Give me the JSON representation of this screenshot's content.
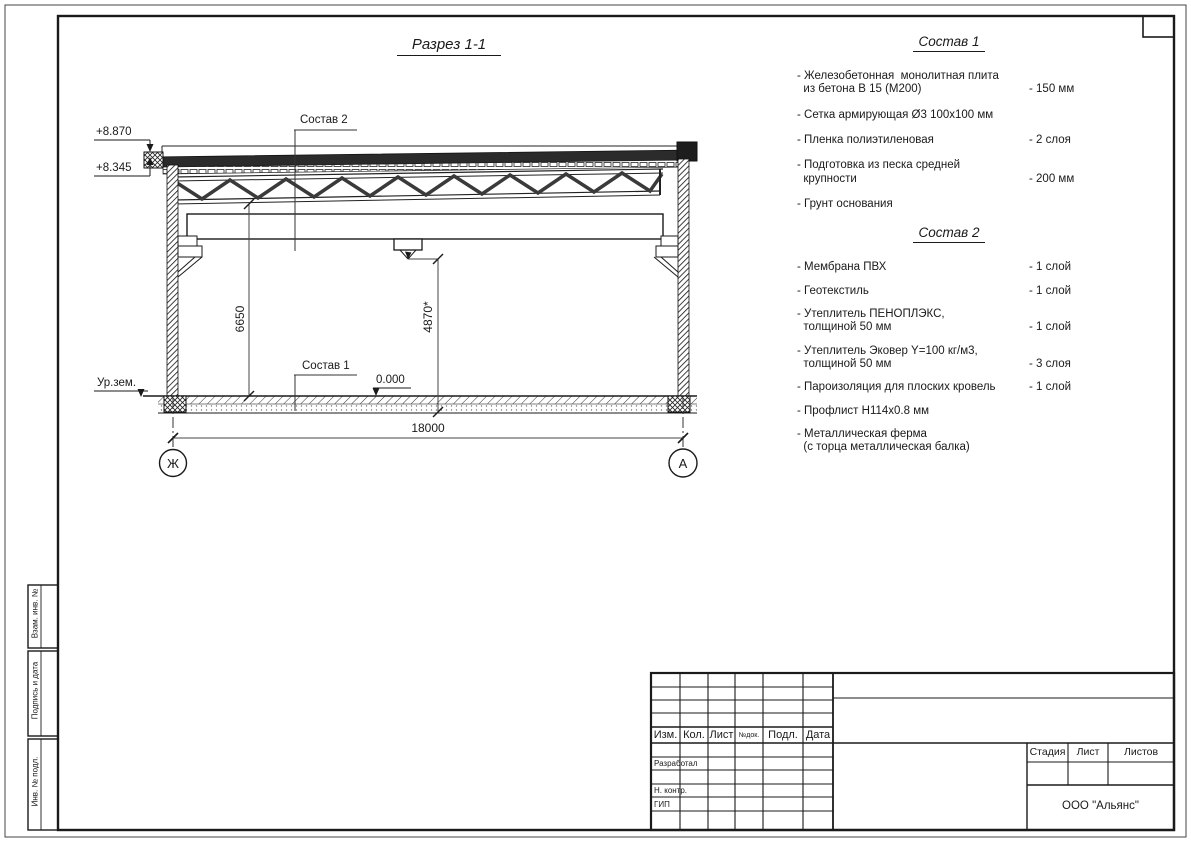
{
  "drawing": {
    "title": "Разрез 1-1",
    "callout_sostav2": "Состав 2",
    "callout_sostav1": "Состав 1",
    "elevation_top": "+8.870",
    "elevation_eave": "+8.345",
    "ground_level_label": "Ур.зем.",
    "floor_level": "0.000",
    "dim_height_left": "6650",
    "dim_height_center": "4870*",
    "dim_span": "18000",
    "axis_left": "Ж",
    "axis_right": "А"
  },
  "sostav1": {
    "heading": "Состав 1",
    "items": [
      {
        "name": "- Железобетонная  монолитная плита\n  из бетона В 15 (М200)",
        "value": "- 150 мм"
      },
      {
        "name": "- Сетка армирующая Ø3 100х100 мм",
        "value": ""
      },
      {
        "name": "- Пленка полиэтиленовая",
        "value": "- 2 слоя"
      },
      {
        "name": "- Подготовка из песка средней\n  крупности",
        "value": "- 200 мм"
      },
      {
        "name": "- Грунт основания",
        "value": ""
      }
    ]
  },
  "sostav2": {
    "heading": "Состав 2",
    "items": [
      {
        "name": "- Мембрана ПВХ",
        "value": "- 1 слой"
      },
      {
        "name": "- Геотекстиль",
        "value": "- 1 слой"
      },
      {
        "name": "- Утеплитель ПЕНОПЛЭКС,\n  толщиной 50 мм",
        "value": "- 1 слой"
      },
      {
        "name": "- Утеплитель Эковер Y=100 кг/м3,\n  толщиной 50 мм",
        "value": "- 3 слоя"
      },
      {
        "name": "- Пароизоляция для плоских кровель",
        "value": "- 1 слой"
      },
      {
        "name": "- Профлист Н114х0.8 мм",
        "value": ""
      },
      {
        "name": "- Металлическая ферма\n  (с торца металлическая балка)",
        "value": ""
      }
    ]
  },
  "titleblock": {
    "cols": [
      "Изм.",
      "Кол.",
      "Лист",
      "№док.",
      "Подл.",
      "Дата"
    ],
    "row_labels": [
      "Разработал",
      "Н. контр.",
      "ГИП"
    ],
    "stage": "Стадия",
    "sheet": "Лист",
    "sheets": "Листов",
    "company": "ООО \"Альянс\""
  },
  "side_stamps": [
    "Взам. инв. №",
    "Подпись и дата",
    "Инв. № подл."
  ]
}
